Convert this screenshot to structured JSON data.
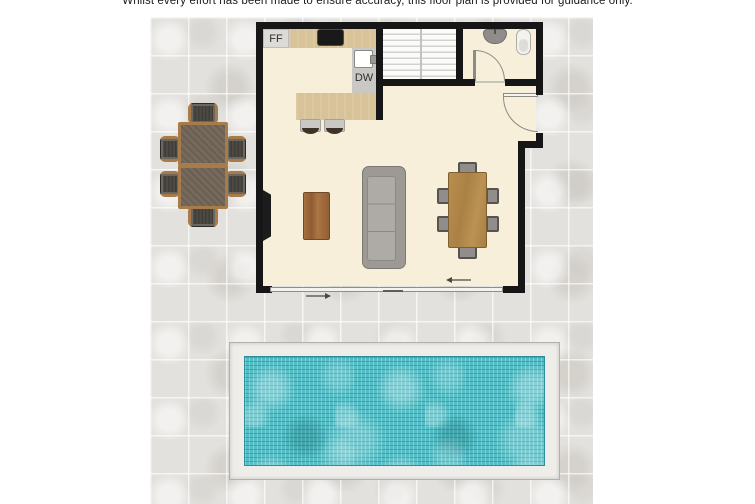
{
  "disclaimer": "Whilst every effort has been made to ensure accuracy, this floor plan is provided for guidance only.",
  "labels": {
    "fridge_freezer": "FF",
    "dishwasher": "DW"
  },
  "colors": {
    "wall": "#161616",
    "interior_floor": "#f8efdb",
    "kitchen_counter": "#d8c297",
    "paving_tile": "#e3e1dd",
    "pool_water": "#53bcc4",
    "pool_surround": "#efedea",
    "sofa": "#9d9a95",
    "wood_furniture": "#a87c4a",
    "dining_table_wood": "#b98f4e"
  }
}
